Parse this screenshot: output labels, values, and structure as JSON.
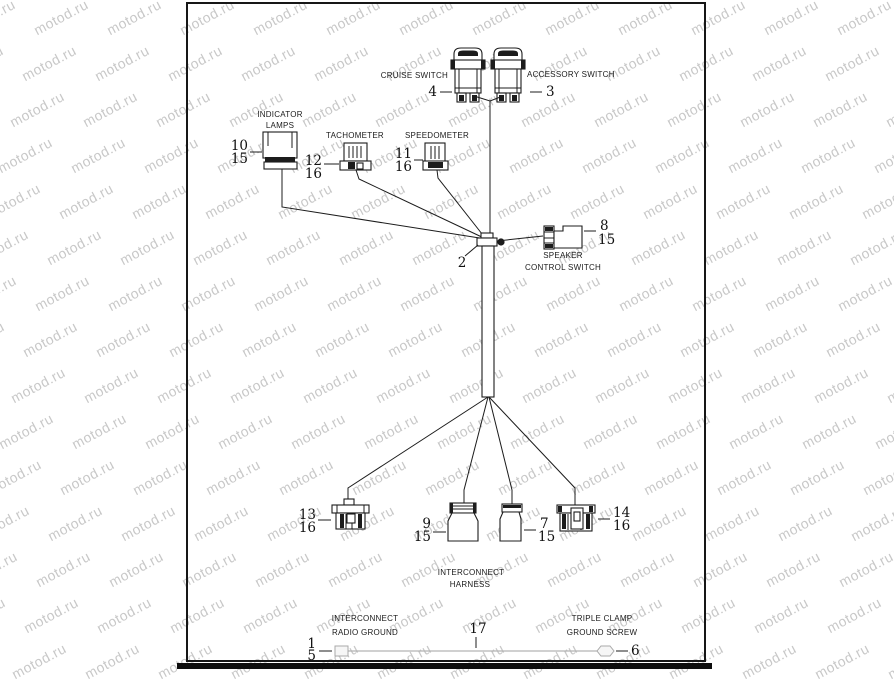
{
  "watermark": {
    "text": "motod.ru",
    "color": "#c8c8c8"
  },
  "colors": {
    "ink": "#1c1c1c",
    "faded_wire": "#b4b4b4",
    "watermark": "#c8c8c8"
  },
  "diagram": {
    "labels": {
      "cruise_switch": "CRUISE SWITCH",
      "accessory_switch": "ACCESSORY SWITCH",
      "indicator_line1": "INDICATOR",
      "indicator_line2": "LAMPS",
      "tachometer": "TACHOMETER",
      "speedometer": "SPEEDOMETER",
      "speaker_line1": "SPEAKER",
      "speaker_line2": "CONTROL SWITCH",
      "harness_line1": "INTERCONNECT",
      "harness_line2": "HARNESS",
      "radio_ground_line1": "INTERCONNECT",
      "radio_ground_line2": "RADIO GROUND",
      "triple_clamp_line1": "TRIPLE CLAMP",
      "triple_clamp_line2": "GROUND SCREW"
    },
    "refs": {
      "cruise": "4",
      "accessory": "3",
      "indicator_top": "10",
      "indicator_bottom": "15",
      "tach_top": "12",
      "tach_bottom": "16",
      "speedo_top": "11",
      "speedo_bottom": "16",
      "junction": "2",
      "speaker_top": "8",
      "speaker_bottom": "15",
      "conn13_top": "13",
      "conn13_bottom": "16",
      "conn9_top": "9",
      "conn9_bottom": "15",
      "conn7_top": "7",
      "conn7_bottom": "15",
      "conn14_top": "14",
      "conn14_bottom": "16",
      "harness_wire": "17",
      "radio_ground_top": "1",
      "radio_ground_bottom": "5",
      "ground_screw": "6"
    }
  }
}
